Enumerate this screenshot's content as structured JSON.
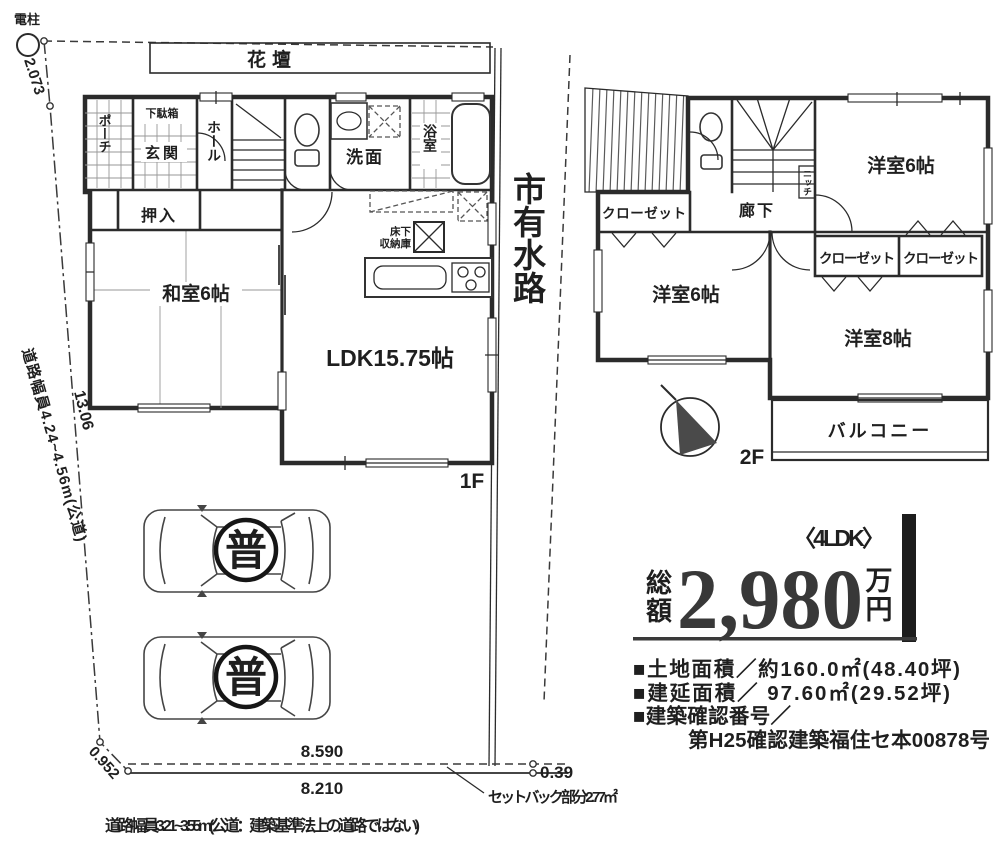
{
  "site": {
    "pole_label": "電柱",
    "dim_top_left": "2.073",
    "flower_bed": "花壇",
    "left_boundary_dim": "13.06",
    "left_road_note": "道路幅員4.24~4.56m(公道)",
    "bottom_left_dim": "0.952",
    "bottom_dim_upper": "8.590",
    "bottom_dim_lower": "8.210",
    "bottom_right_dim": "0.39",
    "setback_note": "セットバック部分2.77㎡",
    "bottom_road_note": "道路幅員3.21~3.55m(公道：建築基準法上の道路ではない)",
    "waterway_label": "市有水路",
    "parking_badge": "普"
  },
  "floor1": {
    "floor_label": "1F",
    "porch": "ポーチ",
    "shoe_cabinet": "下駄箱",
    "entrance": "玄関",
    "hall": "ホール",
    "closet": "押入",
    "tatami_room": "和室6帖",
    "washroom": "洗面",
    "bathroom": "浴室",
    "underfloor_line1": "床下",
    "underfloor_line2": "収納庫",
    "ldk": "LDK15.75帖"
  },
  "floor2": {
    "floor_label": "2F",
    "closet_a": "クローゼット",
    "closet_b": "クローゼット",
    "closet_c": "クローゼット",
    "corridor": "廊下",
    "niche": "ニッチ",
    "bedroom6_upper": "洋室6帖",
    "bedroom6_lower": "洋室6帖",
    "bedroom8": "洋室8帖",
    "balcony": "バルコニー"
  },
  "price": {
    "plan_type": "〈4LDK〉",
    "prefix_char1": "総",
    "prefix_char2": "額",
    "amount": "2,980",
    "unit_char1": "万",
    "unit_char2": "円"
  },
  "details": {
    "land_area": "■土地面積／約160.0㎡(48.40坪)",
    "building_area": "■建延面積／ 97.60㎡(29.52坪)",
    "confirmation_label": "■建築確認番号／",
    "confirmation_number": "第H25確認建築福住セ本00878号"
  }
}
